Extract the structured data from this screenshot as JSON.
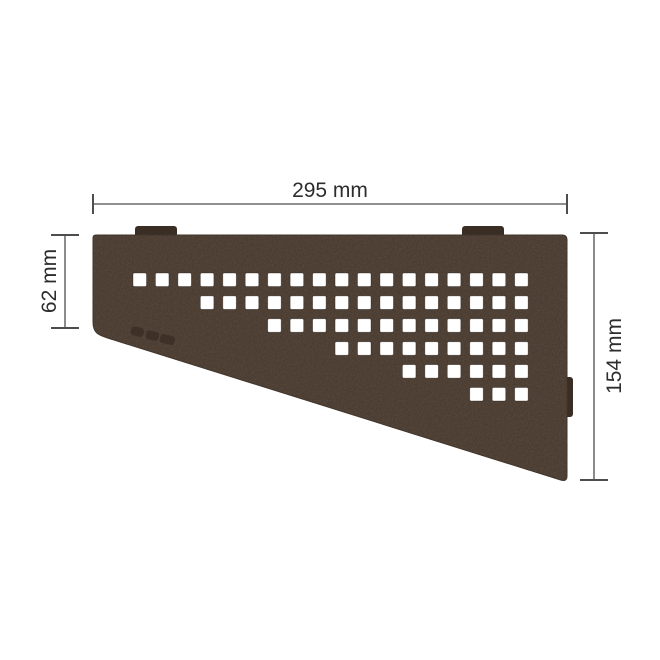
{
  "canvas": {
    "background": "#ffffff"
  },
  "diagram": {
    "name": "corner-shelf-dimension-diagram",
    "dimension_labels": {
      "top_width": "295 mm",
      "left_height": "62 mm",
      "right_height": "154 mm"
    },
    "dimension_line_color": "#4d4d4d",
    "label_color": "#2d2d2d"
  },
  "shelf": {
    "finish_color": "#4a3b2f",
    "edge_color": "#3c2f25",
    "tab_color": "#3a2d23",
    "hole_color": "#ffffff",
    "hole_grid": {
      "origin_x": 133,
      "origin_y": 273,
      "col_pitch": 22.45,
      "row_pitch": 22.9,
      "hole_size": 13.5,
      "rows": [
        {
          "start_col": 1,
          "count": 18
        },
        {
          "start_col": 4,
          "count": 15
        },
        {
          "start_col": 7,
          "count": 12
        },
        {
          "start_col": 10,
          "count": 9
        },
        {
          "start_col": 13,
          "count": 6
        },
        {
          "start_col": 16,
          "count": 3
        }
      ]
    }
  }
}
